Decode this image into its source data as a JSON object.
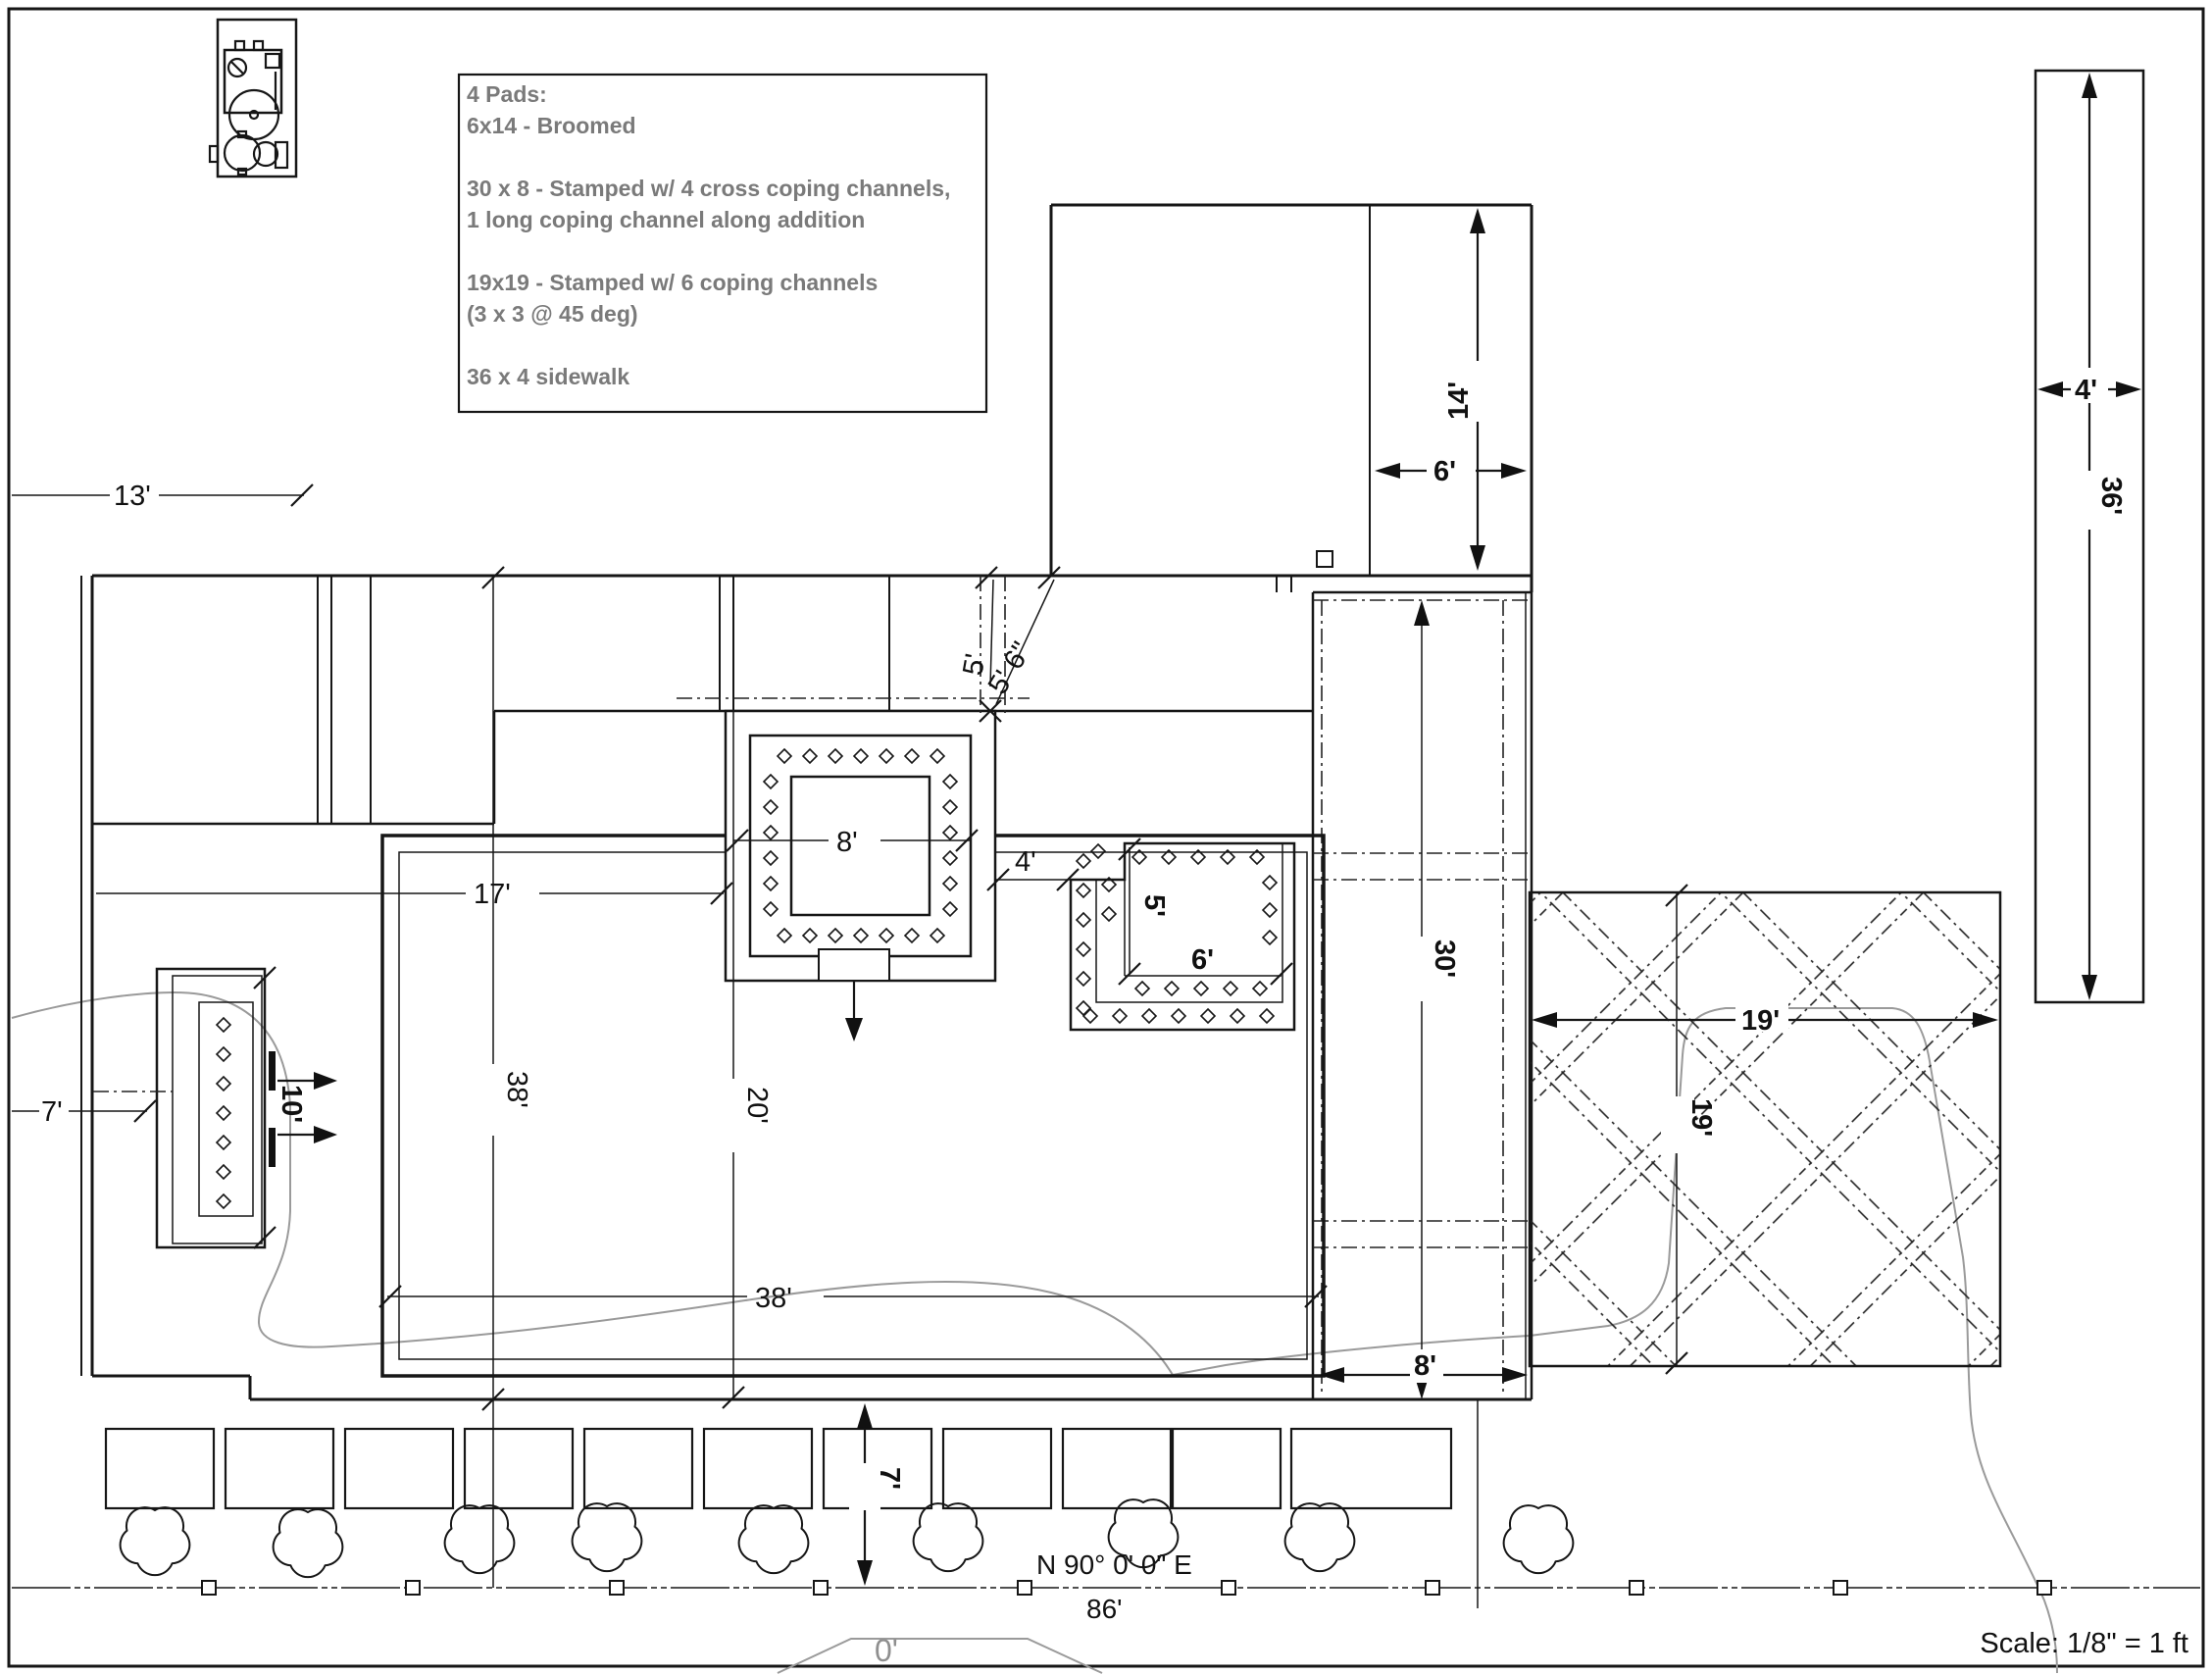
{
  "notes": {
    "lines": [
      "4 Pads:",
      "6x14 - Broomed",
      "30 x 8 - Stamped w/ 4 cross coping channels,",
      "1 long coping channel along addition",
      "19x19 - Stamped w/ 6 coping channels",
      "(3 x 3 @ 45 deg)",
      "36 x 4 sidewalk"
    ]
  },
  "survey": {
    "bearing": "N 90° 0' 0\" E",
    "frontage_dim": "86'",
    "contour_elevation": "0'"
  },
  "scale_note": "Scale: 1/8\" = 1 ft",
  "dims": {
    "d13": "13'",
    "d7_left": "7'",
    "d17": "17'",
    "d38_v": "38'",
    "d38_h": "38'",
    "d20": "20'",
    "d8_spa": "8'",
    "d4_ledge": "4'",
    "d5_spa": "5'",
    "d5_6_spa": "5' 6\"",
    "d5_ledge": "5'",
    "d6_ledge": "6'",
    "d10_feature": "10'",
    "d14_pad": "14'",
    "d6_pad": "6'",
    "d30_pad": "30'",
    "d8_pad": "8'",
    "d19_w": "19'",
    "d19_h": "19'",
    "d4_walk": "4'",
    "d36_walk": "36'",
    "d7_walk": "7'"
  },
  "icons": {
    "equipment": "pool-equipment-icon",
    "tree": "tree-icon",
    "survey_marker": "survey-marker-icon"
  },
  "colors": {
    "line": "#161616",
    "note_text": "#7a7a7a",
    "contour": "#9a9a9a"
  }
}
